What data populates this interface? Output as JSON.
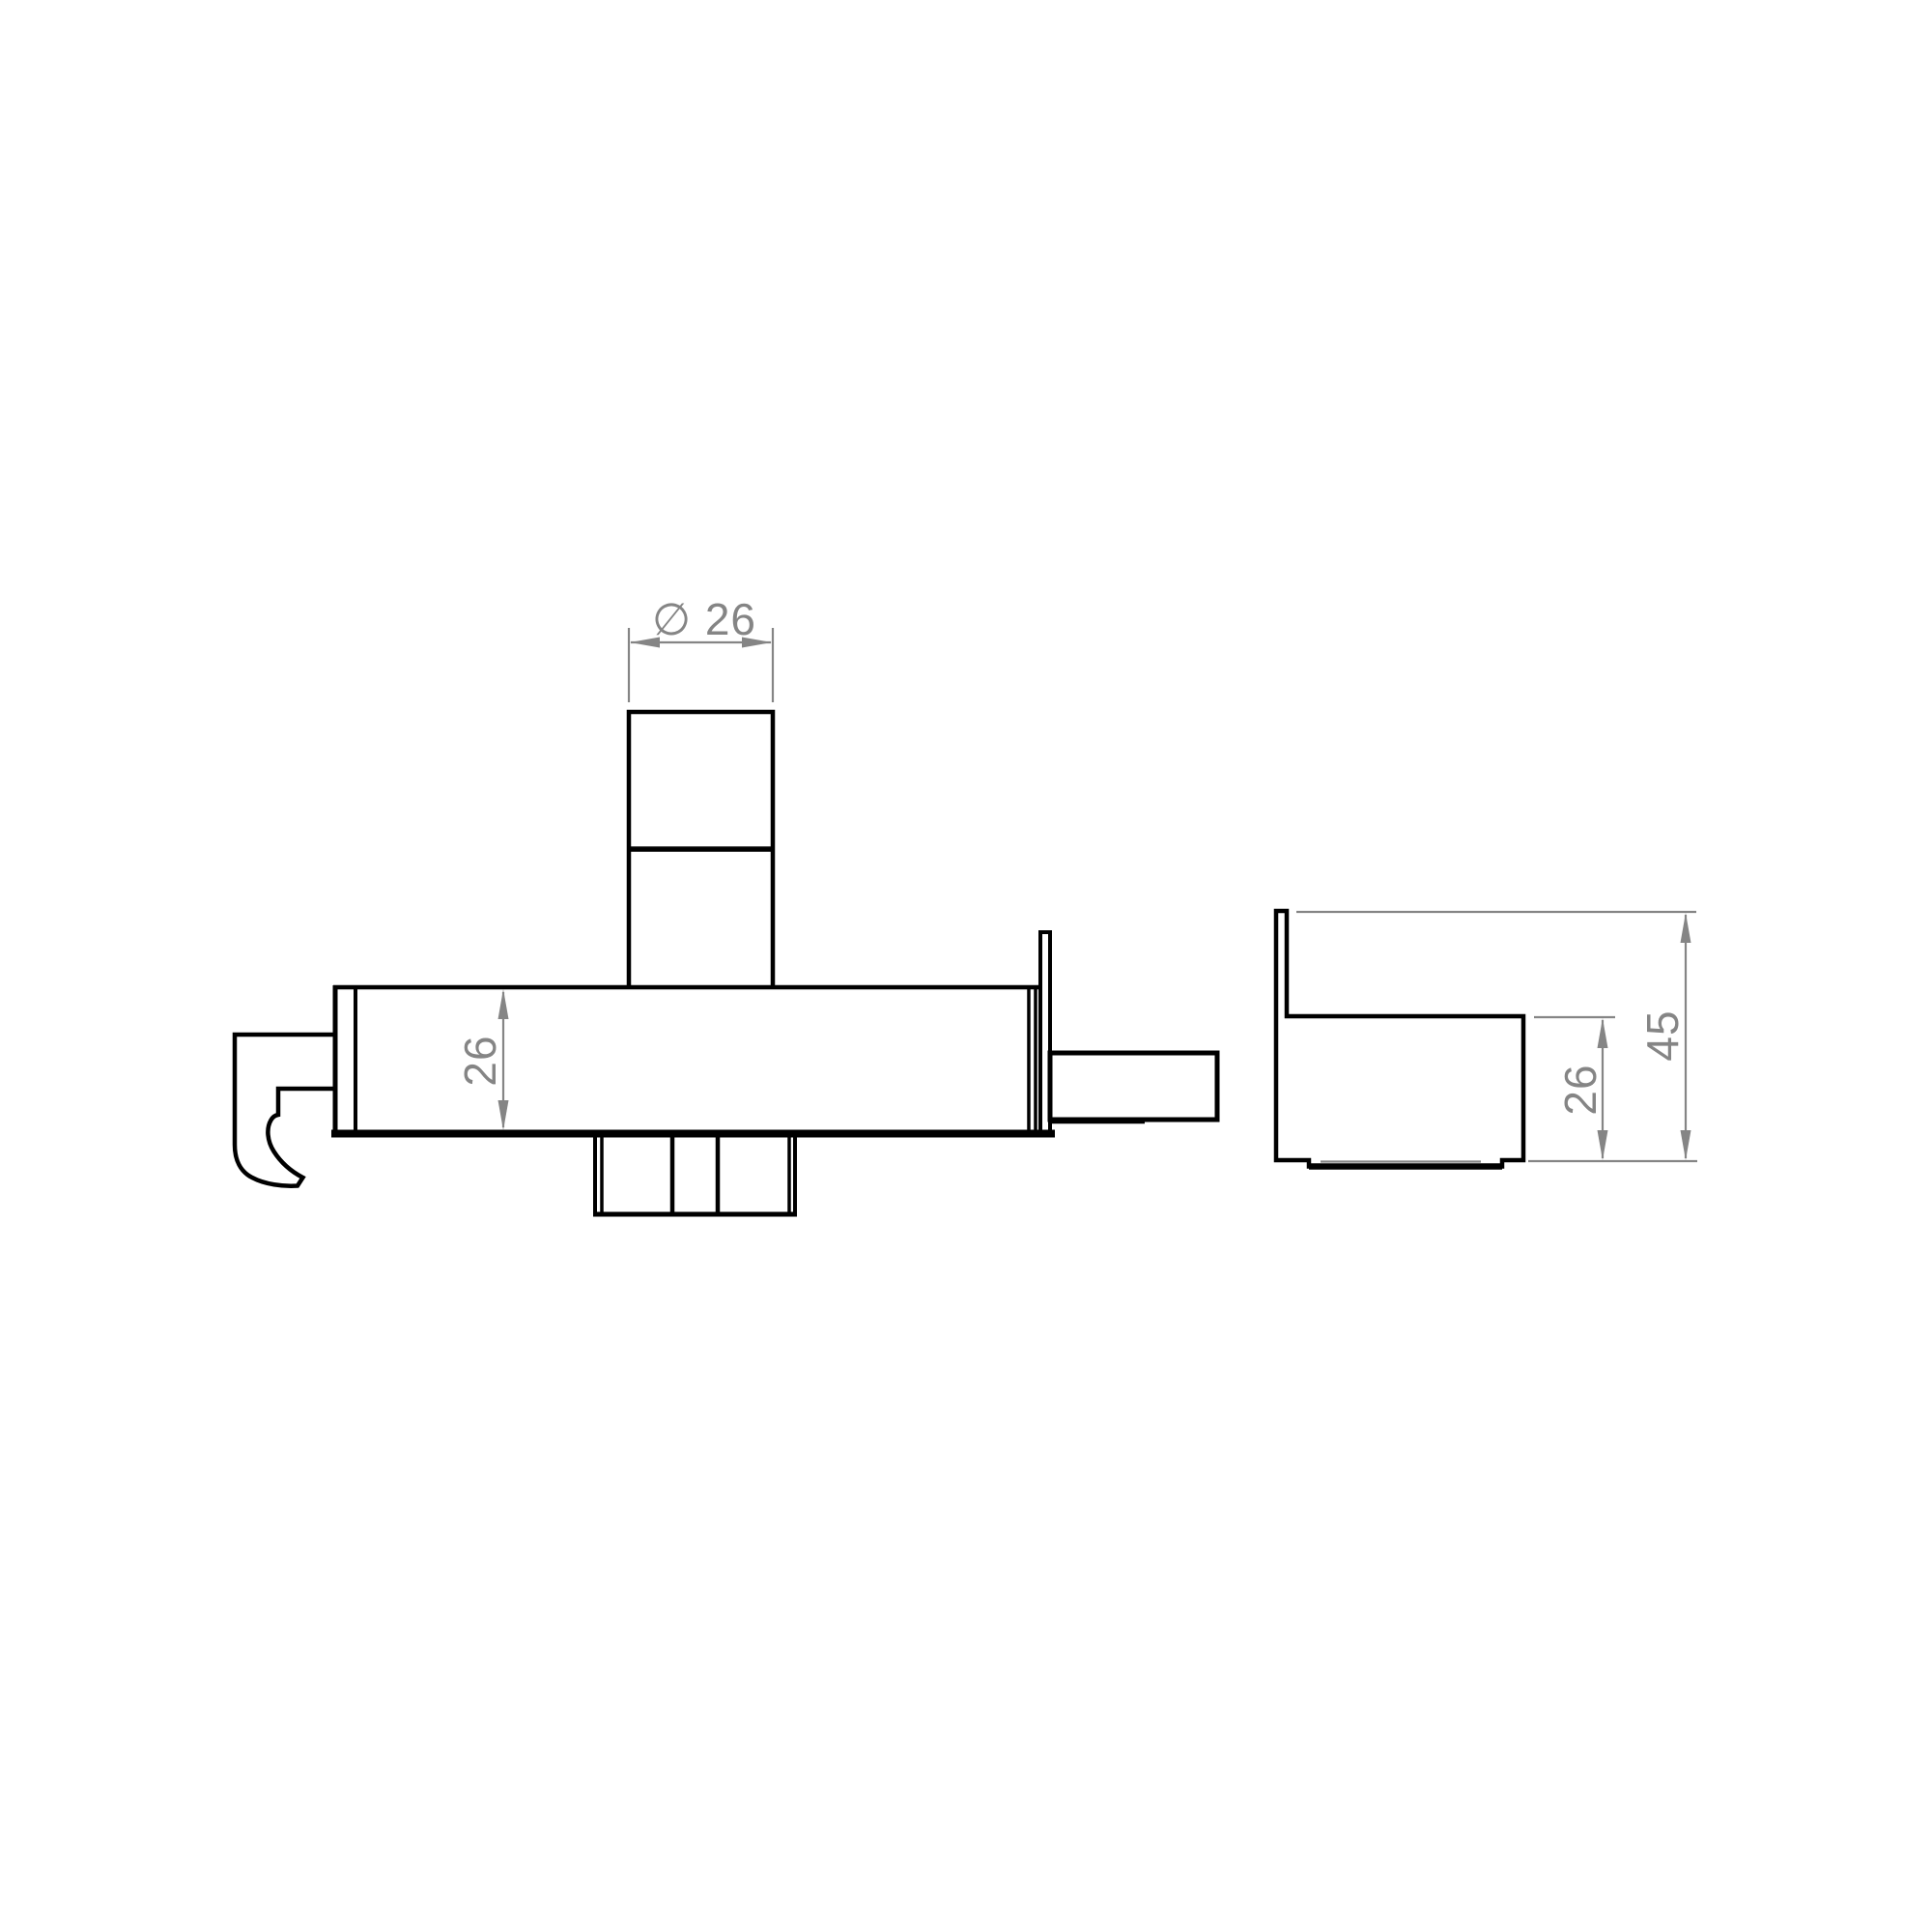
{
  "drawing": {
    "background_color": "#ffffff",
    "line_color": "#000000",
    "dimension_color": "#858585",
    "dimensions": {
      "spindle_diameter": "∅ 26",
      "front_body_height": "26",
      "side_body_height": "26",
      "side_total_height": "45"
    }
  }
}
